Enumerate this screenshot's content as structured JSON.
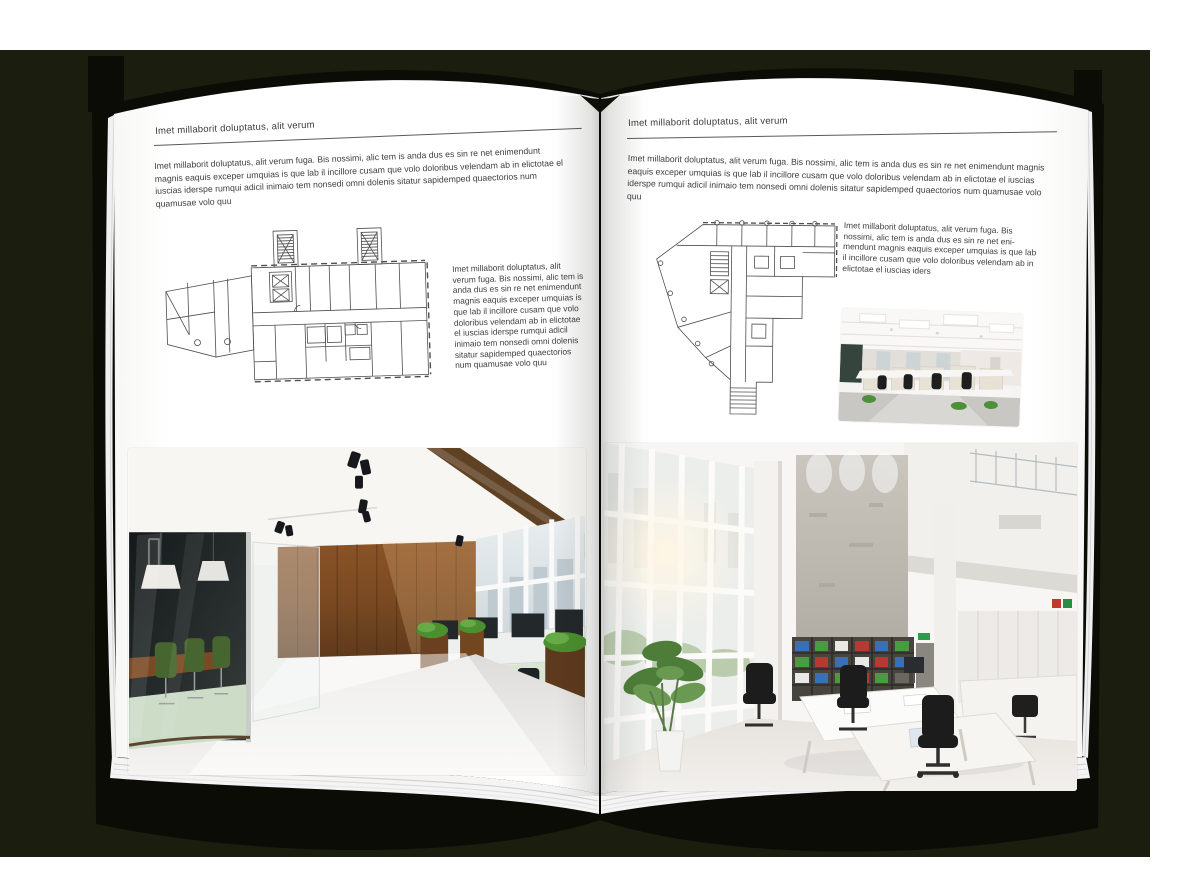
{
  "colors": {
    "backdrop": "#1b1d0f",
    "cover": "#0b0c06",
    "page": "#ffffff",
    "wood_accent": "#7c4e27",
    "plant_green": "#4e8f32",
    "meeting_chair_green": "#47662f"
  },
  "book": {
    "left_page": {
      "header": "Imet millaborit doluptatus, alit verum",
      "intro": "Imet millaborit doluptatus, alit verum fuga. Bis nossimi, alic tem is anda dus es sin re net enimendunt magnis eaquis exceper umquias is que lab il incillore cusam que volo doloribus velendam ab in elictotae el iuscias iderspe rumqui adicil inimaio tem nonsedi omni dolenis sitatur sapidemped quaectorios num quamusae volo quu",
      "side_text": "Imet millaborit doluptatus, alit verum fuga. Bis nossimi, alic tem is anda dus es sin re net enimendunt magnis eaquis exceper umquias is que lab il incillore cusam que volo doloribus velendam ab in elictotae el iuscias iderspe rumqui adicil inimaio tem nonsedi omni dolenis sitatur sapidemped quaectorios num quamusae volo quu"
    },
    "right_page": {
      "header": "Imet millaborit doluptatus, alit verum",
      "intro": "Imet millaborit doluptatus, alit verum fuga. Bis nossimi, alic tem is anda dus es sin re net enimendunt magnis eaquis exceper umquias is que lab il incillore cusam que volo doloribus velendam ab in elictotae el iuscias iderspe rumqui adicil inimaio tem nonsedi omni dolenis sitatur sapidemped quaectorios num quamusae volo quu",
      "side_text": "Imet millaborit doluptatus, alit verum fuga. Bis nossimi, alic tem is anda dus es sin re net eni-mendunt magnis eaquis exceper umquias is que lab il incillore cusam que volo doloribus velendam ab in elictotae el iuscias iders"
    }
  },
  "images": {
    "left_floor_plan": "floor-plan-drawing",
    "right_floor_plan": "floor-plan-drawing",
    "small_office_photo": "open-office-photo",
    "left_office_photo": "wood-and-glass-office-photo",
    "right_office_photo": "white-loft-office-photo"
  }
}
